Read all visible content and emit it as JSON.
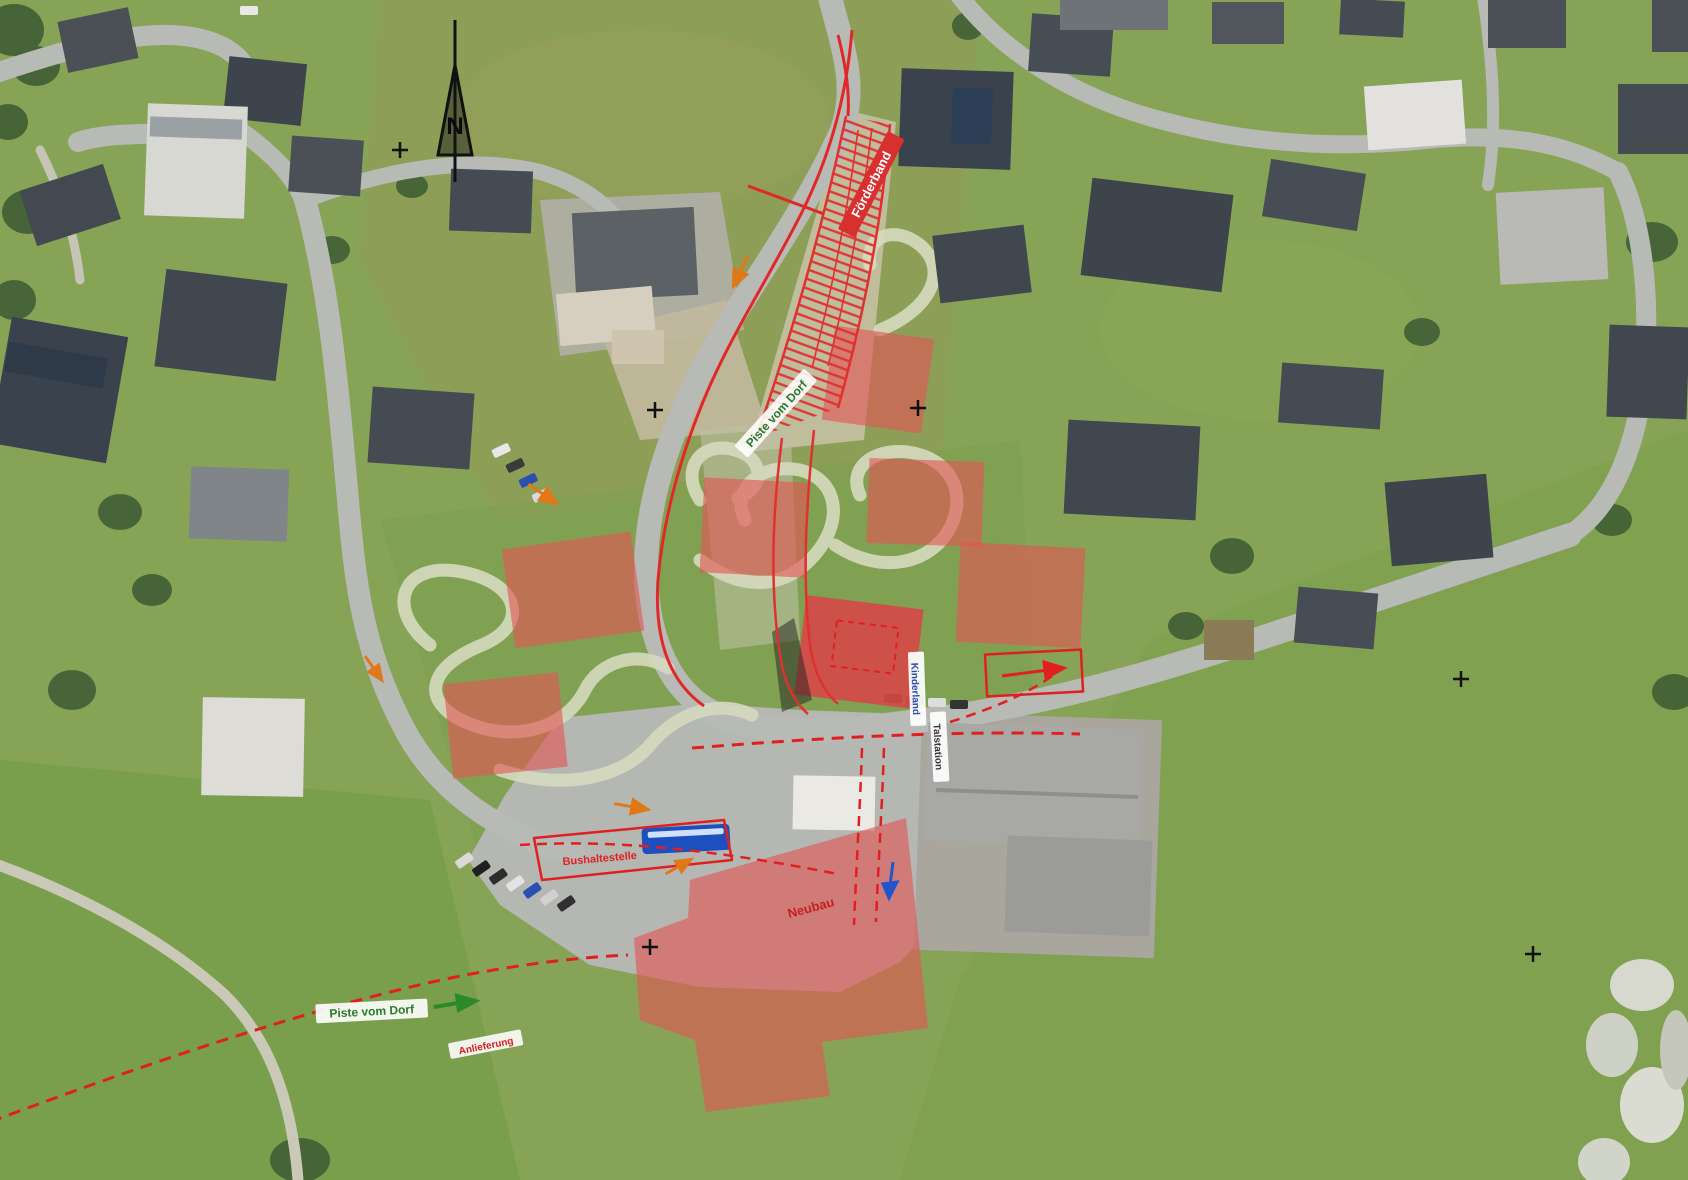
{
  "map": {
    "type": "aerial-site-plan",
    "north_label": "N",
    "labels": {
      "conveyor_band": "Förderband",
      "piste_upper": "Piste vom Dorf",
      "piste_lower": "Piste vom Dorf",
      "building_vertical": "Kinderland",
      "station_vertical": "Talstation",
      "bus_zone": "Bushaltestelle",
      "delivery": "Anlieferung",
      "new_building": "Neubau"
    },
    "colors": {
      "overlay_red": "#e25555",
      "line_red": "#e02828",
      "hatch_red": "#e03030",
      "label_green": "#2a7a2a",
      "label_blue": "#2a4fb0",
      "arrow_orange": "#e07818",
      "bus_blue": "#1d4fbe",
      "grass": "#86a356",
      "road_gray": "#b8bab6"
    }
  }
}
